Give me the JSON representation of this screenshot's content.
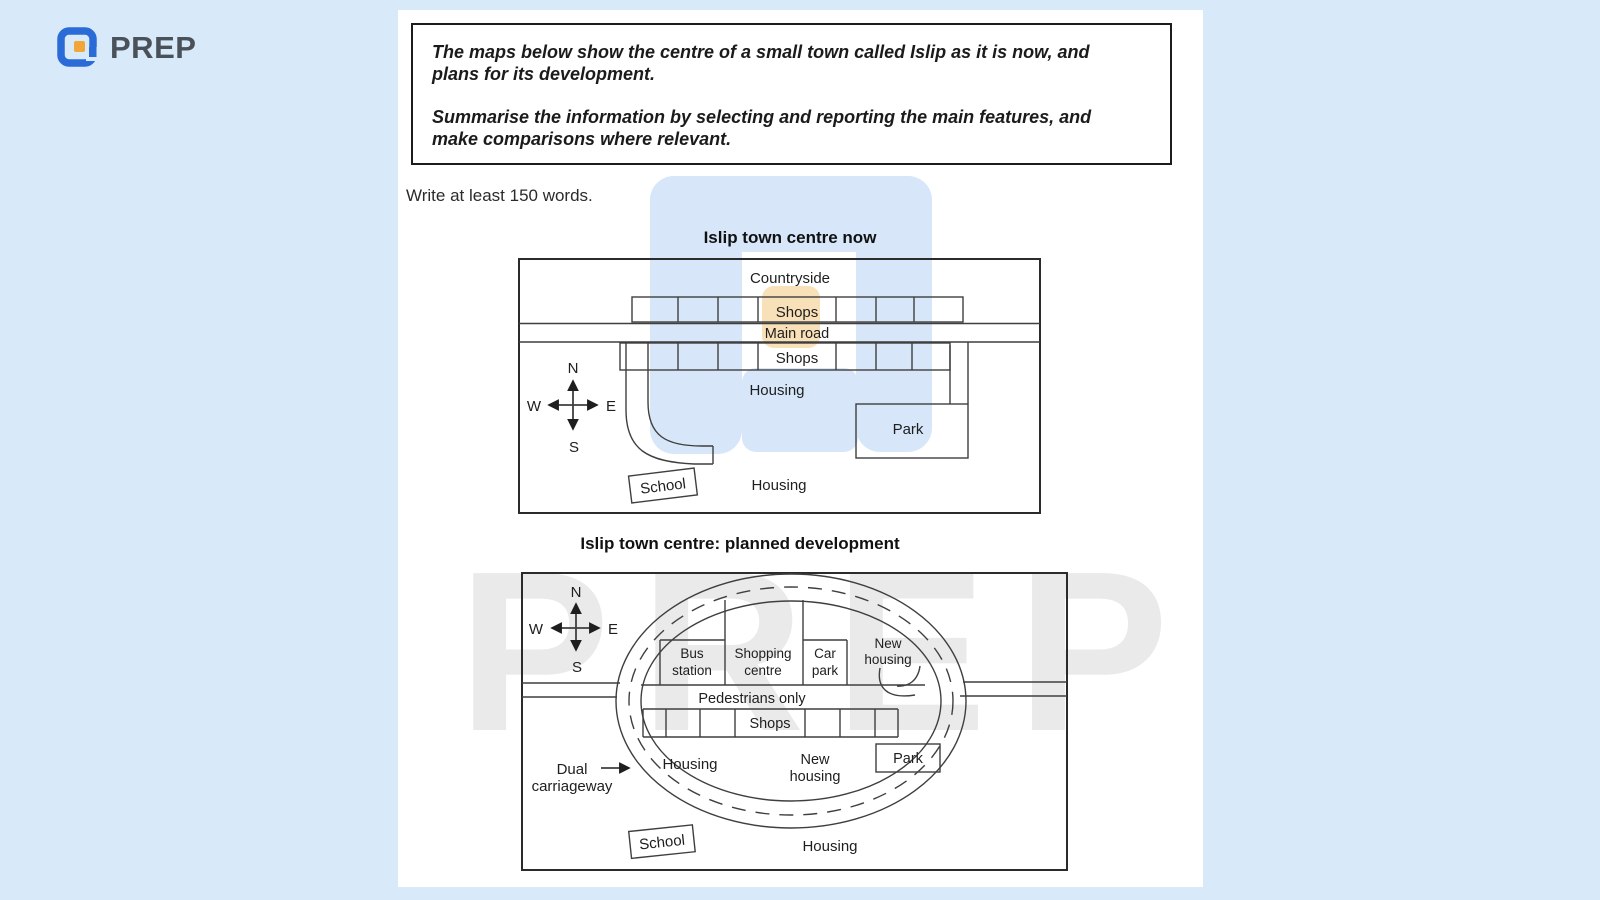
{
  "page": {
    "colors": {
      "background": "#d8e9fa",
      "surface": "#ffffff",
      "brand_blue": "#2b6bd8",
      "brand_orange": "#f1a63a",
      "map_line": "#3f3f3f"
    }
  },
  "header": {
    "brand": "PREP"
  },
  "watermark": {
    "text": "PREP"
  },
  "task": {
    "prompt1_lines": [
      "The maps below show the centre of a small town called Islip as it is now, and",
      "plans for its development."
    ],
    "prompt2_lines": [
      "Summarise the information by selecting and reporting the main features, and",
      "make comparisons where relevant."
    ],
    "instruction": "Write at least 150 words."
  },
  "map_now": {
    "title": "Islip town centre now",
    "compass": {
      "n": "N",
      "s": "S",
      "e": "E",
      "w": "W"
    },
    "labels": {
      "countryside": "Countryside",
      "shops_top": "Shops",
      "main_road": "Main road",
      "shops_bottom": "Shops",
      "housing_mid": "Housing",
      "park": "Park",
      "school": "School",
      "housing_bottom": "Housing"
    }
  },
  "map_planned": {
    "title": "Islip town centre: planned development",
    "compass": {
      "n": "N",
      "s": "S",
      "e": "E",
      "w": "W"
    },
    "labels": {
      "bus_station": [
        "Bus",
        "station"
      ],
      "shopping_centre": [
        "Shopping",
        "centre"
      ],
      "car_park": [
        "Car",
        "park"
      ],
      "new_housing_top": [
        "New",
        "housing"
      ],
      "pedestrians_only": "Pedestrians only",
      "shops": "Shops",
      "housing_left": "Housing",
      "new_housing_bottom": [
        "New",
        "housing"
      ],
      "park": "Park",
      "dual_carriageway": [
        "Dual",
        "carriageway"
      ],
      "school": "School",
      "housing_bottom": "Housing"
    }
  }
}
